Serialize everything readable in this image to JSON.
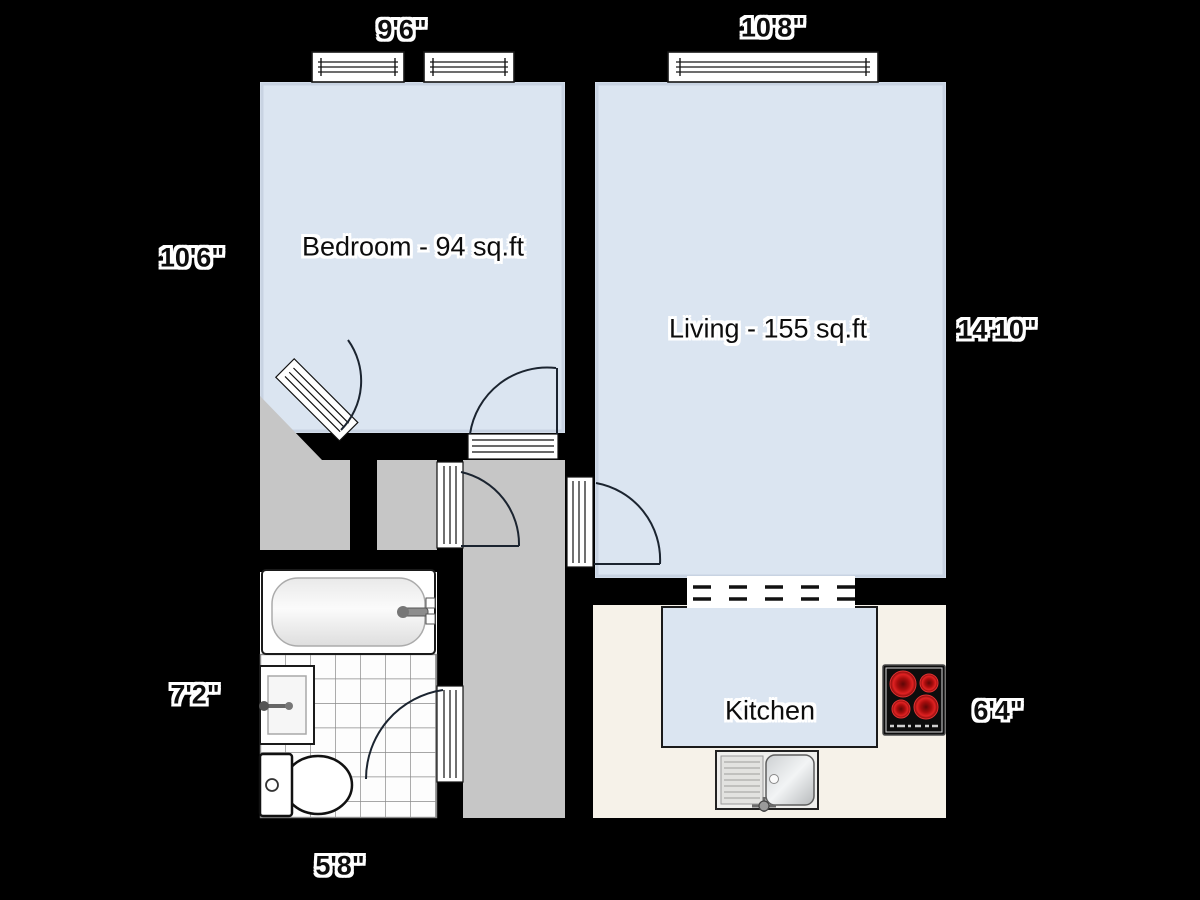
{
  "canvas": {
    "width": 1200,
    "height": 900,
    "background": "#000000"
  },
  "rooms": {
    "bedroom": {
      "label": "Bedroom - 94 sq.ft"
    },
    "living": {
      "label": "Living - 155 sq.ft"
    },
    "kitchen": {
      "label": "Kitchen"
    }
  },
  "dimensions": {
    "bedroom_width_top": "9'6\"",
    "living_width_top": "10'8\"",
    "bedroom_height_left": "10'6\"",
    "living_height_right": "14'10\"",
    "bathroom_height_left": "7'2\"",
    "kitchen_height_right": "6'4\"",
    "bathroom_width_bottom": "5'8\""
  },
  "fixtures": {
    "bathtub": "bathtub",
    "bathroom_sink": "wash-basin",
    "toilet": "toilet",
    "stove": "hob-4-burners",
    "kitchen_sink": "kitchen-sink-with-drainer"
  },
  "colors": {
    "wall": "#000000",
    "room_fill": "#dbe5f1",
    "hallway_fill": "#c6c6c6",
    "kitchen_floor": "#f6f2e9",
    "tile_floor": "#fdfdfd",
    "tile_line": "#8a8a8a",
    "door_swing_line": "#1b2430",
    "burner_red": "#c11414",
    "label_text": "#0d0d0d",
    "label_halo": "#ffffff"
  }
}
